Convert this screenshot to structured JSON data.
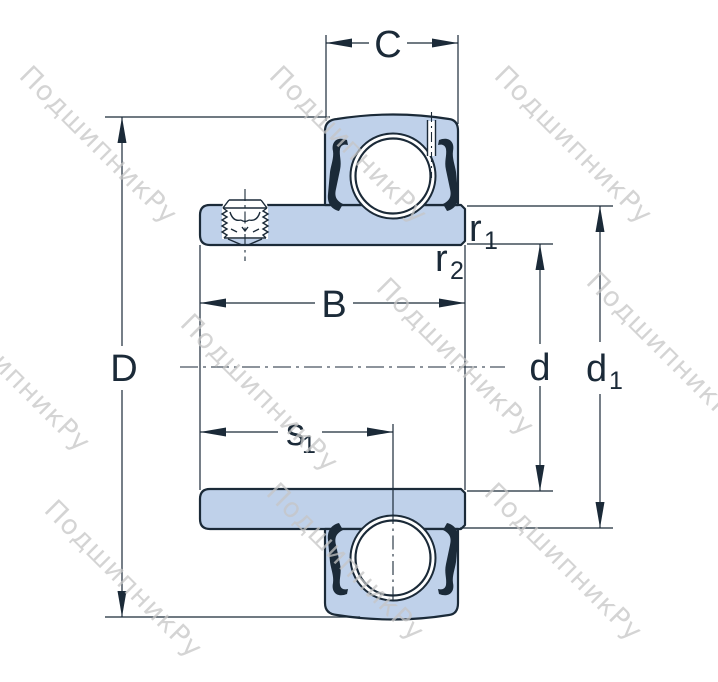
{
  "watermark": {
    "text": "ПодшипникРу"
  },
  "dimensions": {
    "outer_ring_width": "C",
    "outer_diameter": "D",
    "inner_ring_width": "B",
    "bore_diameter": "d",
    "d1": {
      "base": "d",
      "sub": "1"
    },
    "r1": {
      "base": "r",
      "sub": "1"
    },
    "r2": {
      "base": "r",
      "sub": "2"
    },
    "s1": {
      "base": "s",
      "sub": "1"
    }
  },
  "colors": {
    "part_fill": "#bfd1ea",
    "ink": "#1b2a38",
    "watermark": "#c6c6c6",
    "background": "#ffffff"
  }
}
